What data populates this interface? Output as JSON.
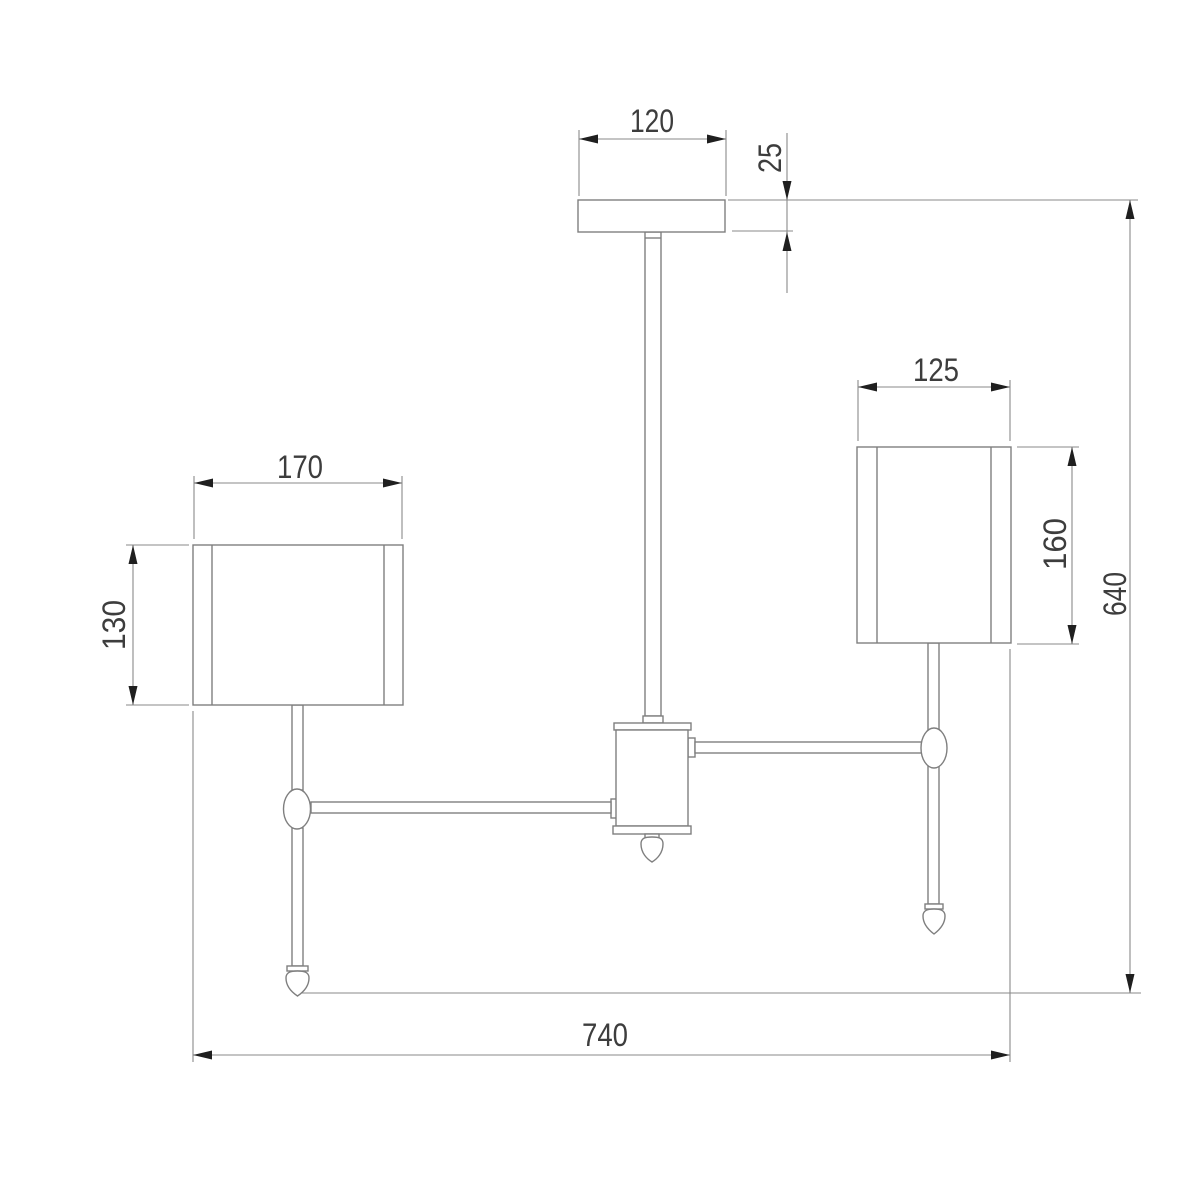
{
  "page": {
    "background": "#ffffff"
  },
  "style": {
    "outline_color": "#7f7f7f",
    "dimension_line_color": "#8a8a8a",
    "arrowhead_color": "#1f1f1f",
    "label_text_color": "#3d3d3d"
  },
  "drawing": {
    "type": "technical-dimension-drawing",
    "parts": [
      "ceiling-canopy",
      "central-stem",
      "central-hub",
      "hub-finial-drop",
      "left-arm",
      "left-ball-joint",
      "left-lamp-rod",
      "left-finial-drop",
      "left-shade",
      "right-arm",
      "right-ball-joint",
      "right-lamp-rod",
      "right-finial-drop",
      "right-shade"
    ]
  },
  "dimensions": {
    "canopy_width": "120",
    "canopy_thickness": "25",
    "left_shade_width": "170",
    "left_shade_height": "130",
    "right_shade_width": "125",
    "right_shade_height": "160",
    "overall_width": "740",
    "overall_height": "640"
  }
}
